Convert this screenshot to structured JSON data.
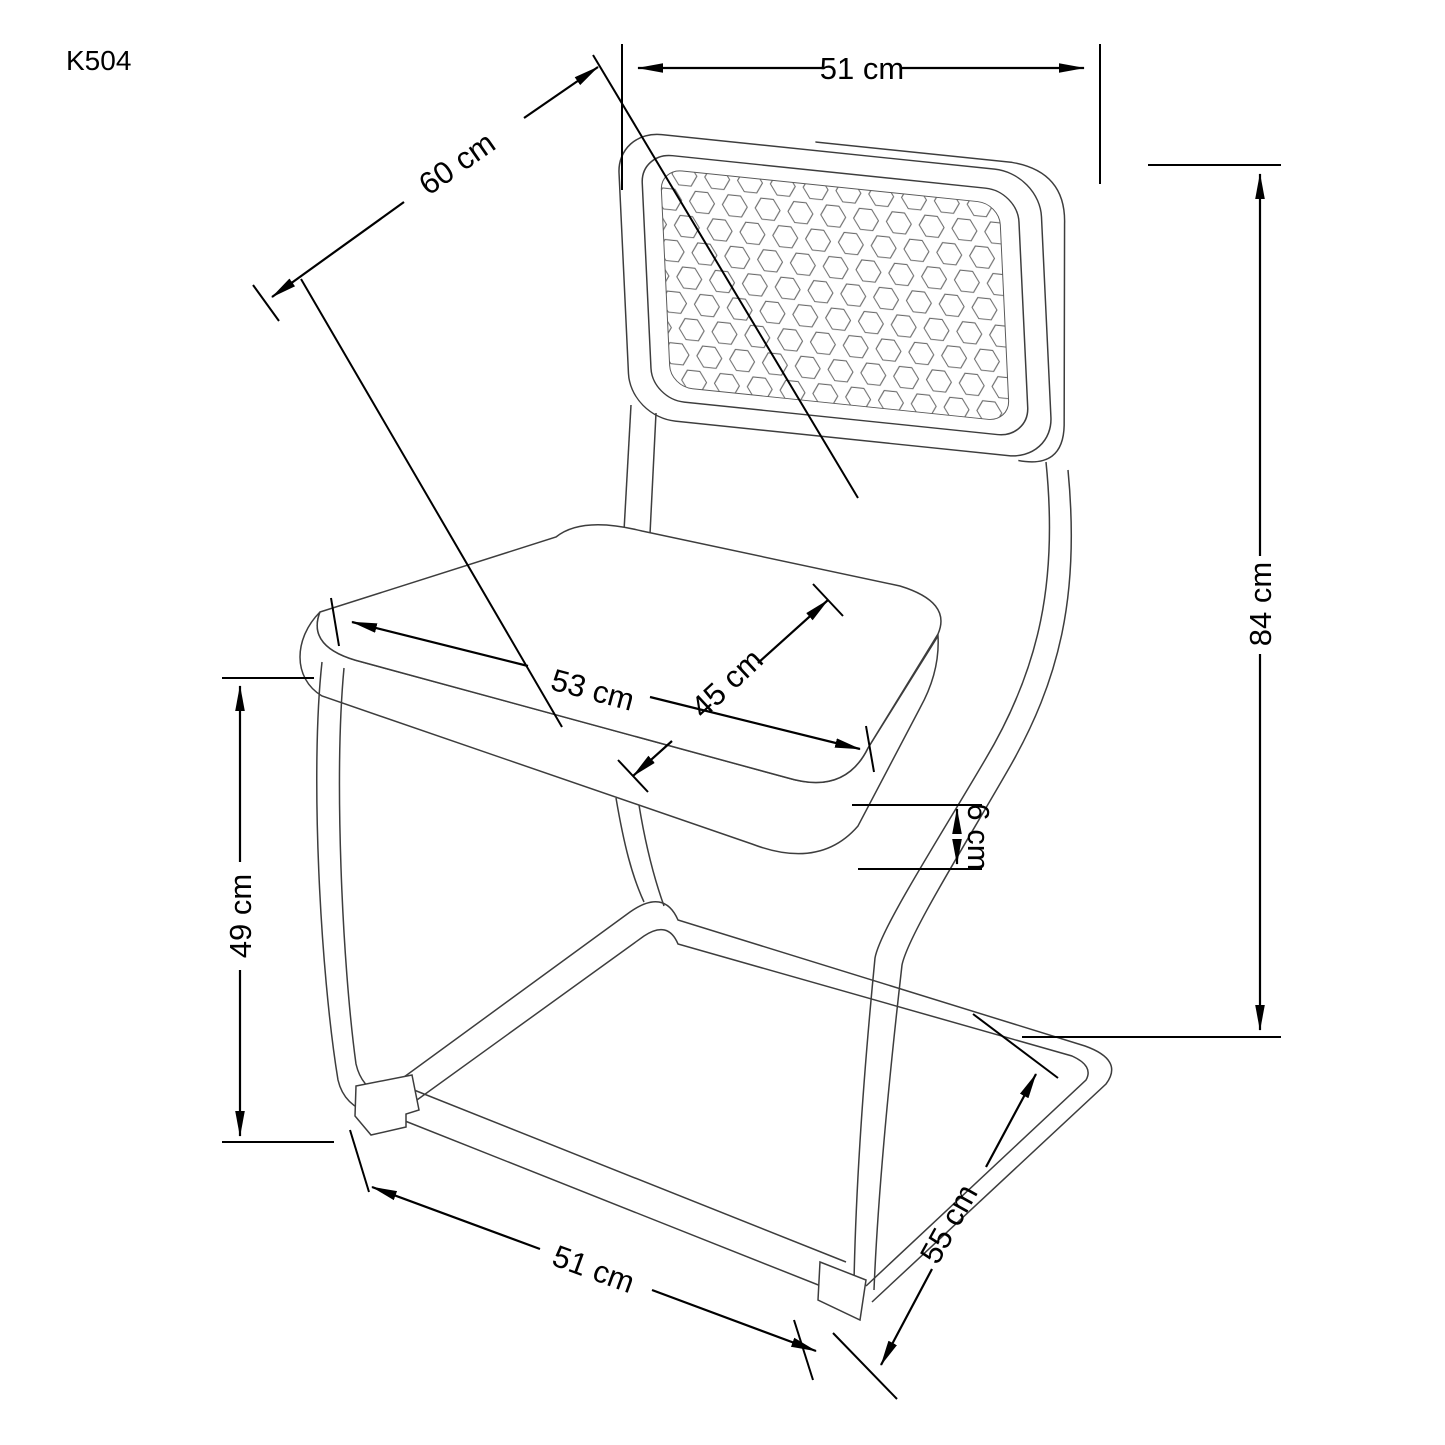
{
  "drawing": {
    "model_code": "K504"
  },
  "dimensions": {
    "backrest_width": "51 cm",
    "backrest_diagonal": "60 cm",
    "overall_height": "84 cm",
    "seat_width": "53 cm",
    "seat_depth": "45 cm",
    "cushion_thickness": "6 cm",
    "seat_height": "49 cm",
    "base_width": "51 cm",
    "base_depth": "55 cm"
  },
  "colors": {
    "dimension_lines": "#000000",
    "chair_outline": "#3d3d3d",
    "mesh_lines": "#6a6a6a",
    "background": "#ffffff"
  }
}
